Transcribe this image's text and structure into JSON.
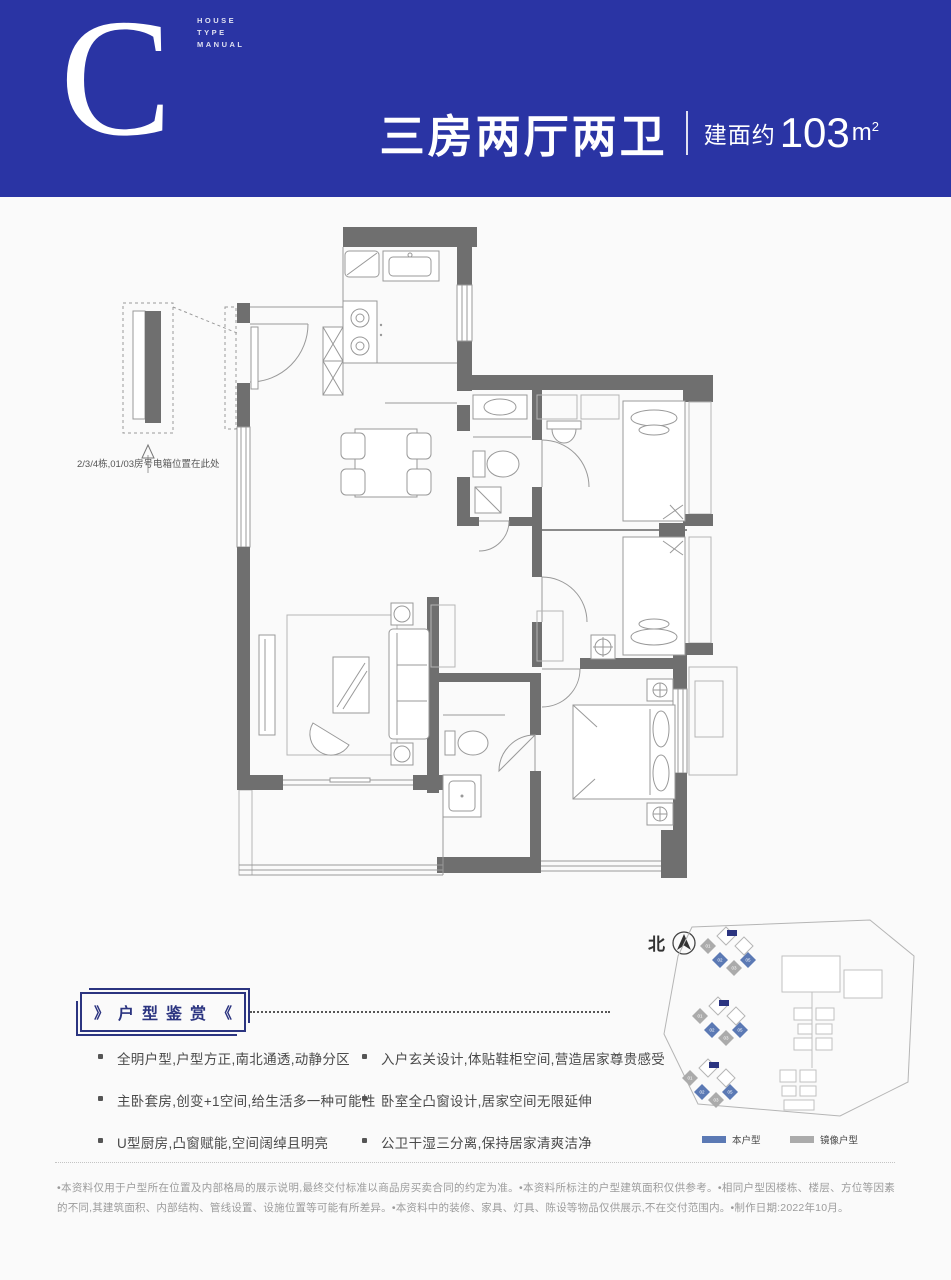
{
  "header": {
    "letter": "C",
    "manual_line1": "HOUSE",
    "manual_line2": "TYPE",
    "manual_line3": "MANUAL",
    "title": "三房两厅两卫",
    "area_prefix": "建面约",
    "area_value": "103",
    "area_unit": "m",
    "area_sup": "2"
  },
  "floor_plan": {
    "callout_note": "2/3/4栋,01/03房号电箱位置在此处"
  },
  "features": {
    "badge_left": "》",
    "badge_text": "户型鉴赏",
    "badge_right": "《",
    "left": [
      "全明户型,户型方正,南北通透,动静分区",
      "主卧套房,创变+1空间,给生活多一种可能性",
      "U型厨房,凸窗赋能,空间阔绰且明亮"
    ],
    "right": [
      "入户玄关设计,体贴鞋柜空间,营造居家尊贵感受",
      "卧室全凸窗设计,居家空间无限延伸",
      "公卫干湿三分离,保持居家清爽洁净"
    ]
  },
  "site_plan": {
    "north_label": "北",
    "legend_this": "本户型",
    "legend_mirror": "镜像户型",
    "unit_labels": [
      "01",
      "02",
      "03",
      "05"
    ]
  },
  "footer": {
    "disclaimer": "•本资料仅用于户型所在位置及内部格局的展示说明,最终交付标准以商品房买卖合同的约定为准。•本资料所标注的户型建筑面积仅供参考。•相同户型因楼栋、楼层、方位等因素的不同,其建筑面积、内部结构、管线设置、设施位置等可能有所差异。•本资料中的装修、家具、灯具、陈设等物品仅供展示,不在交付范围内。•制作日期:2022年10月。"
  },
  "colors": {
    "header_blue": "#2a34a4",
    "badge_navy": "#2b3480",
    "wall_gray": "#6f6f6f",
    "legend_this_blue": "#5b79b4",
    "legend_mirror_gray": "#ababab"
  }
}
